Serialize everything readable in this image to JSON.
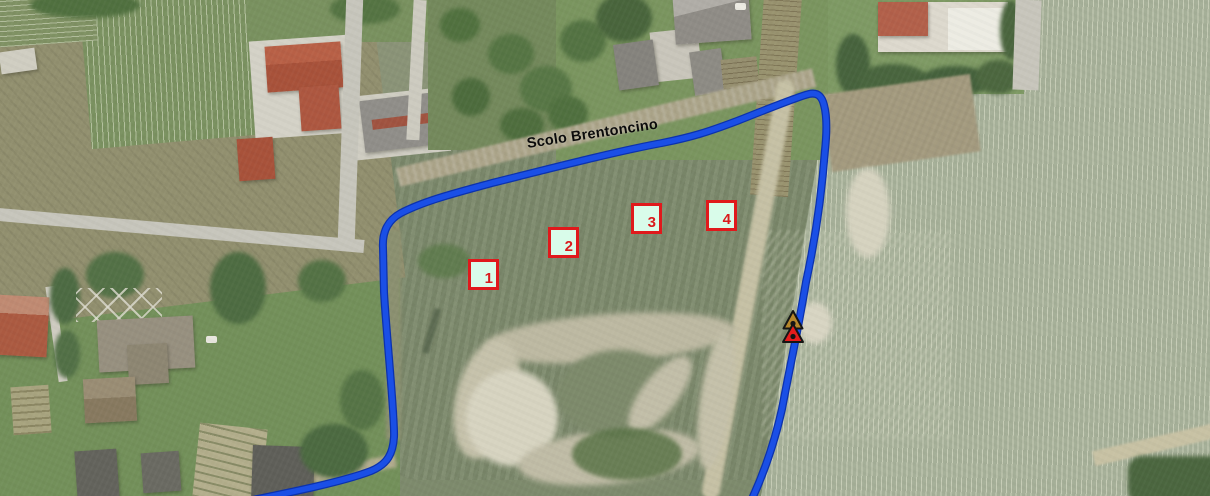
{
  "map": {
    "title": "aerial-map-view",
    "waterway": {
      "label": "Scolo Brentoncino",
      "line_color": "#1647e2"
    },
    "plots": {
      "fill_color": "#d9fcea",
      "border_color": "#e0191c",
      "items": [
        {
          "number": "1"
        },
        {
          "number": "2"
        },
        {
          "number": "3"
        },
        {
          "number": "4"
        }
      ]
    },
    "markers": {
      "upper_triangle_color": "#b5862b",
      "lower_triangle_color": "#e51c1c",
      "outline_color": "#151515"
    }
  }
}
